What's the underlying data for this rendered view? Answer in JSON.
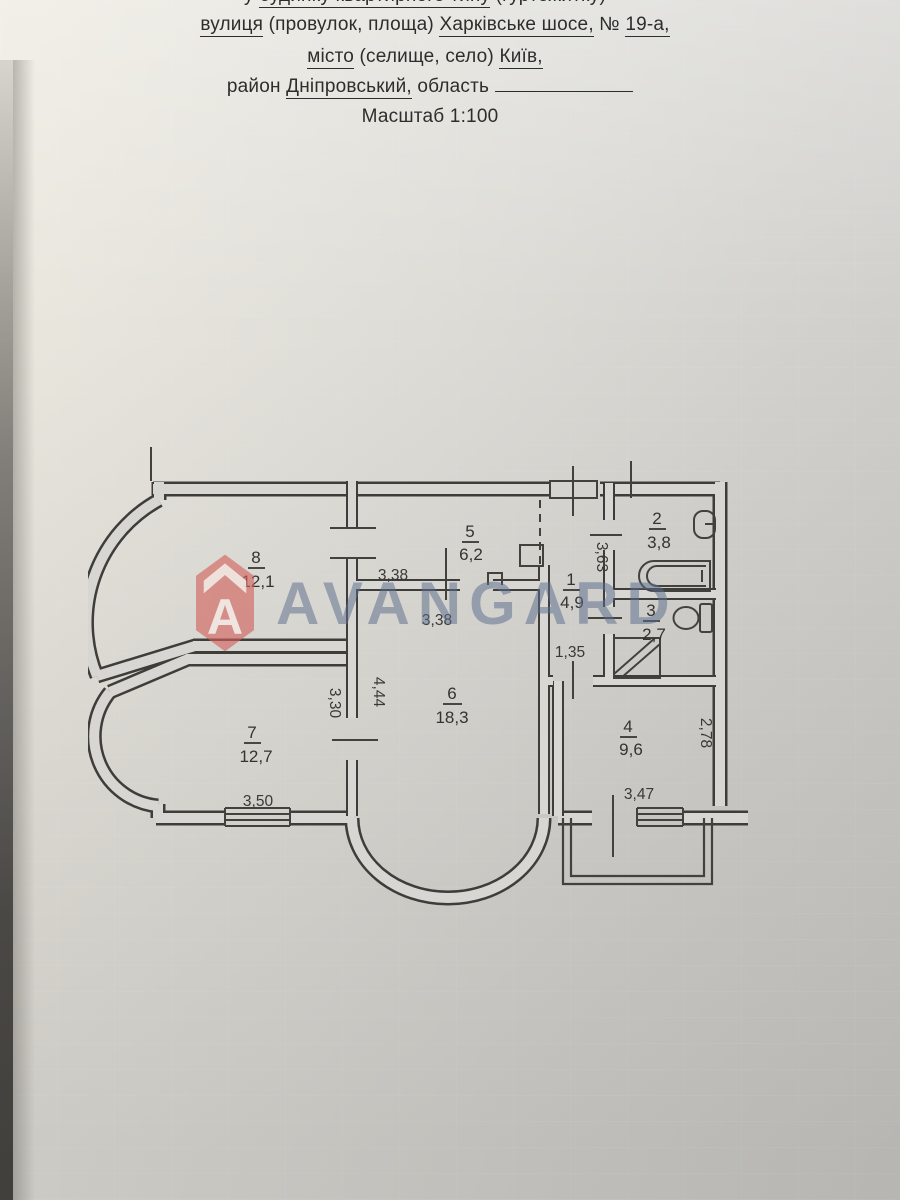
{
  "header": {
    "line1_prefix": "у ",
    "line1_value": "будинку квартирного типу",
    "line1_suffix": " (гуртожитку)",
    "line2_label": "вулиця",
    "line2_mid": " (провулок, площа) ",
    "line2_street": "Харківське шосе,",
    "line2_numsign": " № ",
    "line2_number": "19-а,",
    "line3_label": "місто",
    "line3_mid": " (селище, село) ",
    "line3_city": "Київ,",
    "line4_label": "район ",
    "line4_district": "Дніпровський,",
    "line4_oblast": " область",
    "line5": "Масштаб 1:100"
  },
  "watermark": {
    "brand": "AVANGARD",
    "letter": "A",
    "red": "#d25f5a",
    "blue": "#5c6e8c"
  },
  "plan": {
    "rooms": [
      {
        "number": "1",
        "area": "4,9"
      },
      {
        "number": "2",
        "area": "3,8"
      },
      {
        "number": "3",
        "area": "2,7"
      },
      {
        "number": "4",
        "area": "9,6"
      },
      {
        "number": "5",
        "area": "6,2"
      },
      {
        "number": "6",
        "area": "18,3"
      },
      {
        "number": "7",
        "area": "12,7"
      },
      {
        "number": "8",
        "area": "12,1"
      }
    ],
    "dimensions": {
      "kitchen_width": "3,38",
      "room6_width": "3,38",
      "hall_length": "3,63",
      "hall_width": "1,35",
      "room6_left": "4,44",
      "room7_right": "3,30",
      "room7_width": "3,50",
      "room4_depth": "2,78",
      "room4_width": "3,47"
    }
  }
}
